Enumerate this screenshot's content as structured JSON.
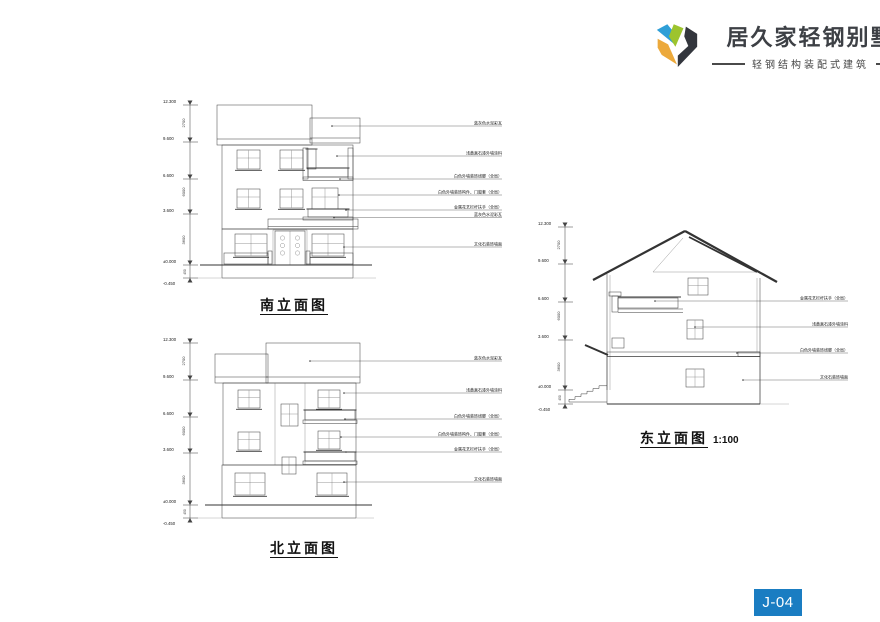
{
  "logo": {
    "brand": "居久家轻钢别墅",
    "tagline": "轻钢结构装配式建筑",
    "colors": {
      "blue": "#2f9fd7",
      "green": "#9dc42e",
      "dark": "#33363d",
      "amber": "#eca93b"
    }
  },
  "sheet_number": "J-04",
  "accent_color": "#1a7dc2",
  "drawings": {
    "south": {
      "title": "南立面图",
      "levels": [
        "12.300",
        "9.600",
        "6.600",
        "3.600",
        "±0.000",
        "-0.450"
      ],
      "dims": [
        "2700",
        "6000",
        "3600",
        "450"
      ],
      "callouts": [
        "蓝灰色水泥彩瓦",
        "浅黄真石漆外墙涂料",
        "白色外墙装饰线脚（全局）",
        "白色外墙装饰构件、门窗套（全局）",
        "金属花艺栏杆扶手（全局）",
        "蓝灰色水泥彩瓦",
        "文化石装饰墙面"
      ]
    },
    "north": {
      "title": "北立面图",
      "levels": [
        "12.300",
        "9.600",
        "6.600",
        "3.600",
        "±0.000",
        "-0.450"
      ],
      "dims": [
        "2700",
        "6000",
        "3600",
        "450"
      ],
      "callouts": [
        "蓝灰色水泥彩瓦",
        "浅黄真石漆外墙涂料",
        "白色外墙装饰线脚（全局）",
        "白色外墙装饰构件、门窗套（全局）",
        "金属花艺栏杆扶手（全局）",
        "文化石装饰墙面"
      ]
    },
    "east": {
      "title": "东立面图",
      "scale": "1:100",
      "levels": [
        "12.300",
        "9.600",
        "6.600",
        "3.600",
        "±0.000",
        "-0.450"
      ],
      "dims": [
        "2700",
        "6000",
        "3600",
        "450"
      ],
      "callouts": [
        "金属花艺栏杆扶手（全局）",
        "浅黄真石漆外墙涂料",
        "白色外墙装饰线脚（全局）",
        "文化石装饰墙面"
      ]
    }
  }
}
